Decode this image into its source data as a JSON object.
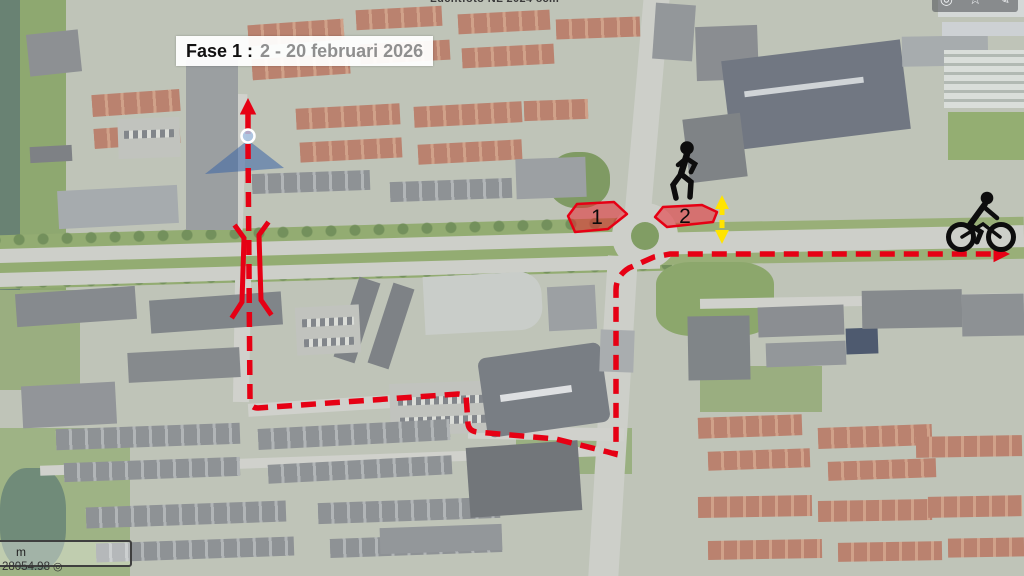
{
  "title_bar": {
    "phase": "Fase 1 :",
    "dates": "2 - 20 februari 2026"
  },
  "watermark": "Luchtfoto NL 2024 8cm",
  "toolbar": {
    "visibility_glyph": "◎",
    "favorite_glyph": "☆",
    "draw_glyph": "✎"
  },
  "map": {
    "zones": [
      {
        "label": "1"
      },
      {
        "label": "2"
      }
    ],
    "scale_bar": {
      "label": "m"
    },
    "coordinates": "28054.98",
    "coordinate_icon_glyph": "◎"
  },
  "colors": {
    "route_red": "#e60014",
    "zone_fill": "rgba(235,30,40,0.5)",
    "zone_stroke": "#e60014",
    "arrow_yellow": "#ffe400",
    "cone_blue": "rgba(58,100,165,0.55)",
    "marker_fill": "#aac6e6",
    "dates_gray": "#8f8f8f"
  }
}
